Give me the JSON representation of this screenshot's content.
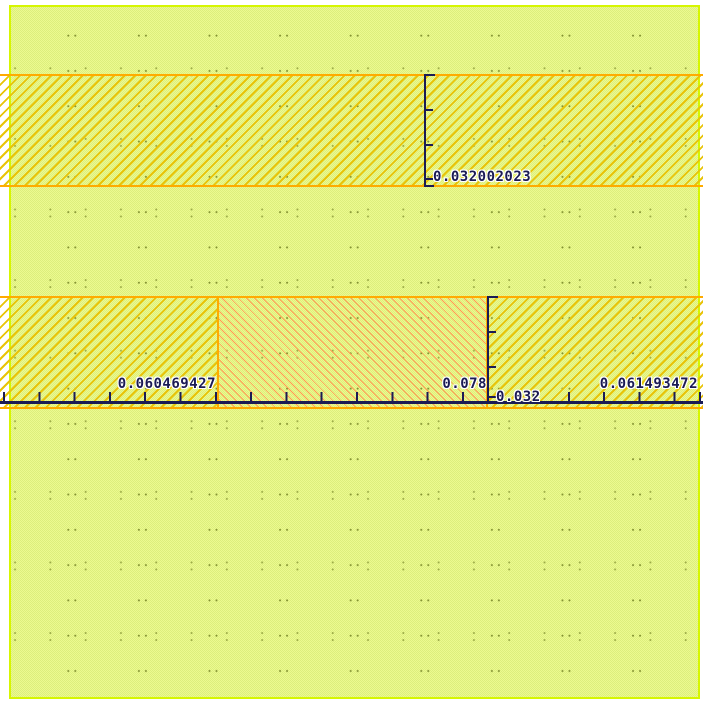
{
  "canvas": {
    "type": "layout-editor-viewport"
  },
  "colors": {
    "page_margin": "#ffffff",
    "background_checker_light": "#ecfa90",
    "background_checker_dark": "#dcee7c",
    "background_border": "#d6f600",
    "grid_dot": "#7d8c2d",
    "band_border": "#ffab00",
    "hatch_gold": "#e8c409",
    "hatch_salmon": "#ff9b55",
    "ruler": "#1b1b55",
    "label_halo": "#ffffff"
  },
  "rulers": {
    "vertical_top_band": {
      "label": "0.032002023"
    },
    "vertical_bottom_band": {
      "label": "0.032"
    },
    "segment_left": {
      "label": "0.060469427"
    },
    "segment_middle": {
      "label": "0.078"
    },
    "segment_right": {
      "label": "0.061493472"
    }
  }
}
